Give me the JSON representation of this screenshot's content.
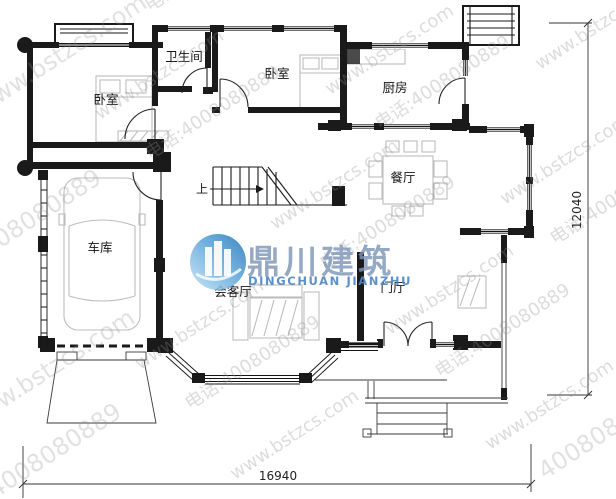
{
  "plan": {
    "rooms": {
      "bedroom1": "卧室",
      "bathroom": "卫生间",
      "bedroom2": "卧室",
      "kitchen": "厨房",
      "dining": "餐厅",
      "garage": "车库",
      "living": "会客厅",
      "foyer": "门厅"
    },
    "stairs_up_label": "上",
    "dimensions": {
      "width": "16940",
      "height": "12040"
    }
  },
  "watermark": {
    "url": "www.bstzcs.com",
    "phone": "4008080889",
    "phone_full": "电话:4008080889",
    "brand_cn": "鼎川建筑",
    "brand_en": "DINGCHUAN JIANZHU"
  },
  "colors": {
    "wall": "#1a1a1a",
    "furniture": "#bdbdbd",
    "watermark_gray": "#8f8f8f",
    "logo_blue_dark": "#1d71b4",
    "logo_blue_light": "#bfe2f6",
    "brand_cn_color": "#8097b8",
    "brand_en_color": "#4f87c5"
  }
}
